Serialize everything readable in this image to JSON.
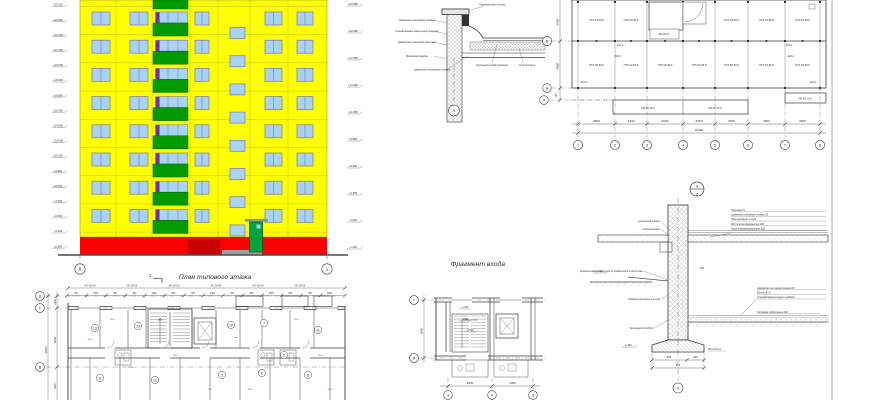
{
  "colors": {
    "facade": "#FFFF00",
    "window_pane": "#A9D3F2",
    "window_frame": "#7878A8",
    "balcony_green": "#009A00",
    "purple_pane": "#7030A0",
    "base_red": "#FF0000",
    "base_dark_red": "#C80000",
    "door_green": "#00A33C",
    "pad_gray": "#9E9E9E",
    "line_dark": "#3C3C3C",
    "line_mid": "#6A6A6A",
    "text": "#2E2E2E"
  },
  "elevation": {
    "axis_left": "8",
    "axis_right": "1",
    "level_marks": [
      "+25.200",
      "+23.800",
      "+22.400",
      "+21.000",
      "+19.600",
      "+18.200",
      "+16.800",
      "+15.400",
      "+14.000",
      "+12.600",
      "+11.200",
      "+9.800",
      "+8.400",
      "+7.000",
      "+5.600",
      "+4.200",
      "+2.800"
    ],
    "section_levels": [
      "+23.980",
      "+20.980",
      "+17.980",
      "+14.980",
      "+11.980",
      "+8.980",
      "+5.980",
      "+2.980",
      "-0.020",
      "-1.200"
    ]
  },
  "parapet_detail": {
    "label_top": "Парапетная плита",
    "labels_left": [
      "Цементно-песчаная стяжка",
      "Алюминиевый защитный фартук",
      "Цементно-песчаный раствор",
      "Фасадная панель"
    ],
    "label_under": "Цементно-песчаная стяжка",
    "labels_right": [
      "Рулонный ковёр (кровля)",
      "Утеплитель"
    ],
    "axis": "А"
  },
  "slab_plan": {
    "bottom_axes": [
      "1",
      "2",
      "3",
      "4",
      "5",
      "6",
      "7",
      "8"
    ],
    "bay_dims": [
      "3600",
      "3300",
      "3600",
      "3300",
      "3300",
      "3600",
      "3600"
    ],
    "total_dim": "24300",
    "left_axes": [
      "В",
      "Б",
      "А"
    ],
    "left_dims": [
      "6000",
      "4800",
      "200"
    ],
    "row1_panels": [
      "ПТК 63-36-8",
      "ПТК 60-30-8",
      "ЛМ 28-11",
      "ПТК 63-36-8",
      "ПТК 72-36-8",
      "ПТК 53-36-8"
    ],
    "row2_panels": [
      "ПТК 48-36-8",
      "ПТК 63-63-8",
      "ПТК 60-36-8",
      "ПТК 63-39-8",
      "ПТК 60-36-8",
      "ПТК 63-36-8",
      "ПТК 48-36-8"
    ],
    "balcony_panels": [
      "ПБ 66-12-8",
      "ПБ 60-12-8",
      "ПБ 36-12-8"
    ],
    "anchor_label": "АКЛ-2"
  },
  "floor_plan": {
    "title": "План типового этажа",
    "section_mark": "1",
    "left_axes": [
      "Д",
      "Г",
      "В"
    ],
    "left_dims": [
      "1440",
      "6000",
      "11500",
      "2800"
    ],
    "wall_panel_label": "НС 30.9.8",
    "top_dims": [
      "750",
      "1500",
      "750",
      "900",
      "1500",
      "900",
      "750",
      "1500",
      "750",
      "900",
      "1500",
      "900",
      "750",
      "1500"
    ],
    "room_numbers": [
      "13",
      "10",
      "10",
      "7",
      "11",
      "8",
      "11",
      "5",
      "6",
      "8",
      "5"
    ],
    "inner_dims": [
      "7500",
      "1500",
      "900",
      "1200",
      "2100",
      "300"
    ]
  },
  "entrance": {
    "title": "Фрагмент входа",
    "bottom_axes": [
      "3",
      "4",
      "5"
    ],
    "bay_dims": [
      "3600",
      "3300"
    ],
    "left_axes": [
      "Г",
      "В"
    ],
    "left_dim": "6000",
    "level_marks": [
      "-1.200",
      "-0.900",
      "-0.600"
    ]
  },
  "foundation_detail": {
    "detail_number": "3",
    "detail_sheet": "2",
    "axis": "А",
    "labels_left": [
      "Цокольная панель",
      "Гидроизоляция",
      "Асфальтовая отмостка по щебёночной подготовке",
      "Обмазка битумом в 2 слоя",
      "Бетонный столбик"
    ],
    "floor_layers": [
      "Линолеум 5",
      "Цементно-песчаная стяжка 20",
      "Пароизоляция 1 слой",
      "Ж/б плита перекрытия 220",
      "Плита минераловатная 100"
    ],
    "ground_layers": [
      "Цементно-песчаная стяжка 20",
      "Бетон В7,5",
      "Утрамбованный грунт щебнем"
    ],
    "bedding_label": "Песчаная подготовка 100",
    "footing_mark": "ФЛ 10-12-2",
    "level_marks": [
      "-1.100",
      "-2.150"
    ],
    "wall_thickness": "300",
    "dims": [
      "600",
      "300"
    ],
    "total_dim": "900"
  }
}
